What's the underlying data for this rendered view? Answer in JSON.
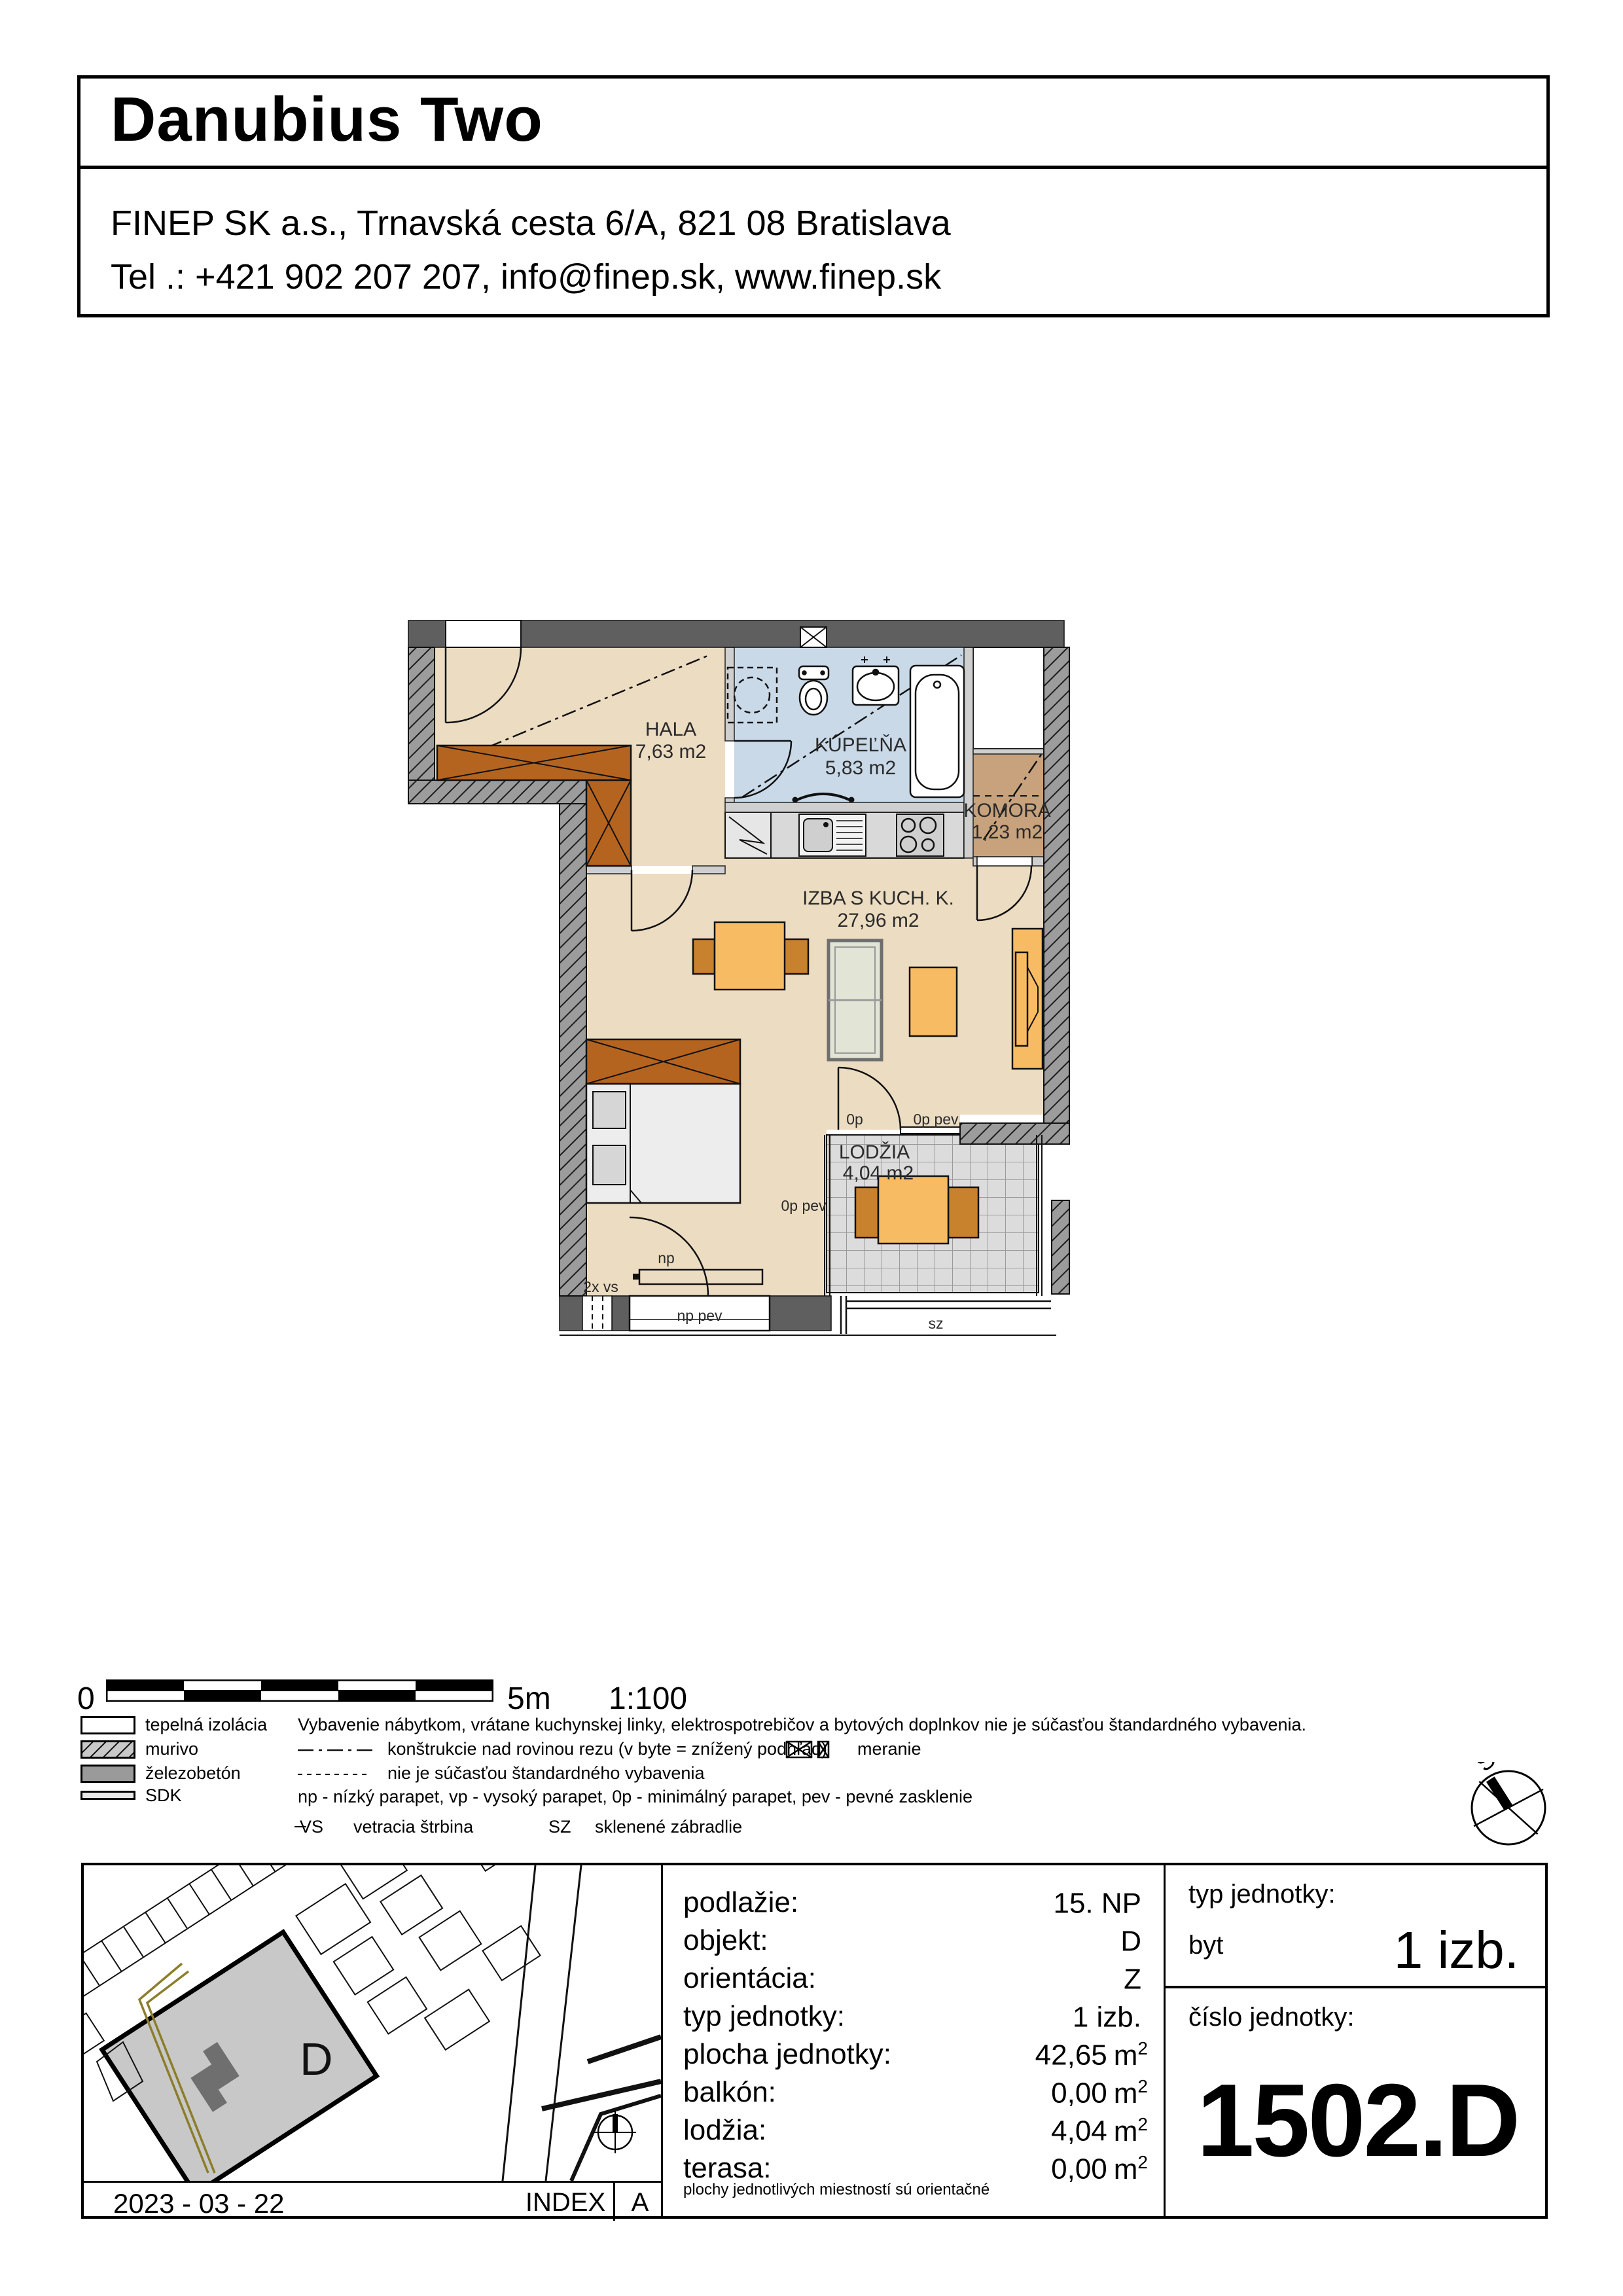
{
  "header": {
    "title": "Danubius Two",
    "address": "FINEP SK a.s., Trnavská cesta 6/A, 821 08 Bratislava",
    "contact": "Tel .: +421 902 207 207, info@finep.sk, www.finep.sk"
  },
  "plan": {
    "rooms": {
      "hala": {
        "name": "HALA",
        "area": "7,63 m2"
      },
      "kupelna": {
        "name": "KÚPEĽŇA",
        "area": "5,83 m2"
      },
      "komora": {
        "name": "KOMORA",
        "area": "1,23 m2"
      },
      "izba": {
        "name": "IZBA S KUCH. K.",
        "area": "27,96 m2"
      },
      "lodzia": {
        "name": "LODŽIA",
        "area": "4,04 m2"
      }
    },
    "marks": {
      "op": "0p",
      "op_pev_top": "0p pev",
      "op_pev_bottom": "0p pev",
      "np": "np",
      "np_pev": "np pev",
      "vs": "2x vs",
      "sz": "sz"
    },
    "colors": {
      "floor": "#ecdcc1",
      "bath": "#c9d9e8",
      "komora": "#c7a27c",
      "tile": "#dcdcdc",
      "wall_dark": "#5f5f5f",
      "wall_hatch_bg": "#9c9c9c",
      "furniture": "#f7bc63",
      "chair": "#c8822d",
      "wardrobe": "#b5641f"
    }
  },
  "scalebar": {
    "zero": "0",
    "end": "5m",
    "ratio": "1:100"
  },
  "legend": {
    "items": [
      {
        "label": "tepelná izolácia"
      },
      {
        "label": "murivo"
      },
      {
        "label": "železobetón"
      },
      {
        "label": "SDK"
      }
    ],
    "note_equipment": "Vybavenie nábytkom, vrátane kuchynskej linky, elektrospotrebičov a bytových doplnkov nie je súčasťou štandardného vybavenia.",
    "note_section": "konštrukcie nad rovinou rezu (v byte = znížený podhľad)",
    "note_meranie": "meranie",
    "note_dashed": "nie je súčasťou štandardného vybavenia",
    "note_parapet": "np - nízký parapet, vp - vysoký parapet, 0p - minimálný parapet, pev - pevné zasklenie",
    "vs_abbr": "VS",
    "vs_text": "vetracia štrbina",
    "sz_abbr": "SZ",
    "sz_text": "sklenené zábradlie"
  },
  "compass": {
    "north": "S"
  },
  "map": {
    "building": "D"
  },
  "table": {
    "rows": [
      {
        "label": "podlažie:",
        "value": "15. NP"
      },
      {
        "label": "objekt:",
        "value": "D"
      },
      {
        "label": "orientácia:",
        "value": "Z"
      },
      {
        "label": "typ jednotky:",
        "value": "1 izb."
      },
      {
        "label": "plocha jednotky:",
        "value": "42,65",
        "unit": "m",
        "sup": "2"
      },
      {
        "label": "balkón:",
        "value": "0,00",
        "unit": "m",
        "sup": "2"
      },
      {
        "label": "lodžia:",
        "value": "4,04",
        "unit": "m",
        "sup": "2"
      },
      {
        "label": "terasa:",
        "value": "0,00",
        "unit": "m",
        "sup": "2"
      }
    ],
    "footnote": "plochy jednotlivých miestností sú orientačné"
  },
  "unit_type": {
    "label": "typ jednotky:",
    "kind": "byt",
    "value": "1 izb."
  },
  "unit_number": {
    "label": "číslo jednotky:",
    "value": "1502.D"
  },
  "footer": {
    "date": "2023 - 03 - 22",
    "index": "INDEX",
    "rev": "A"
  }
}
